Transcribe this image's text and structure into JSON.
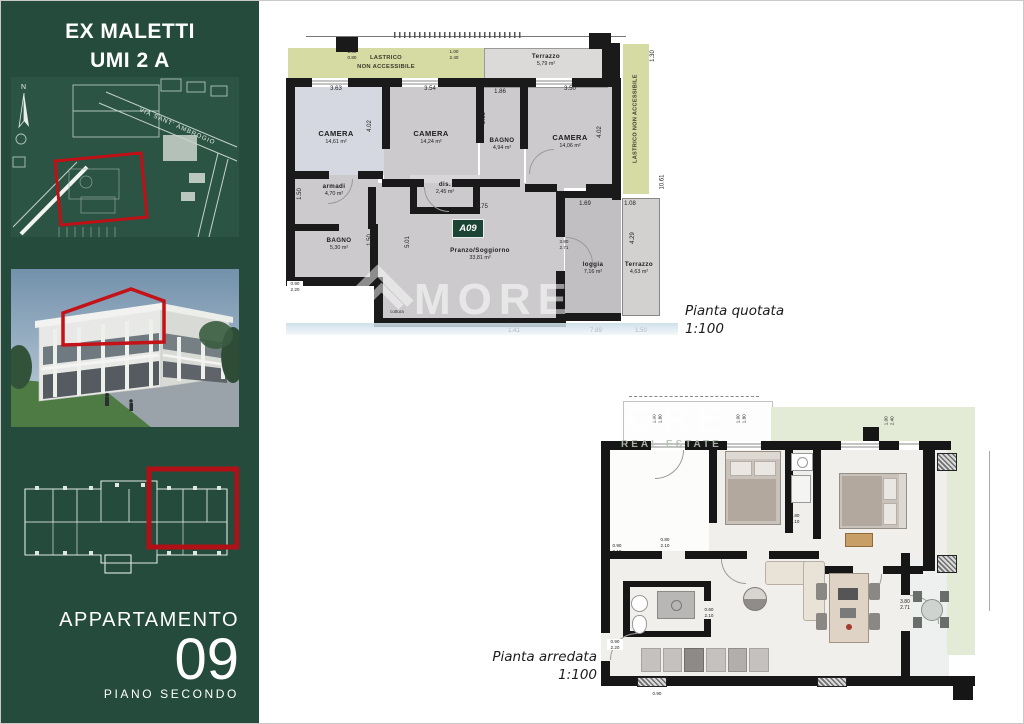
{
  "sidebar": {
    "title_line1": "EX MALETTI",
    "title_line2": "UMI 2 A",
    "north_label": "N",
    "street_label": "VIA SANT' AMBROGIO",
    "apartment_label": "APPARTAMENTO",
    "apartment_number": "09",
    "floor_label": "PIANO SECONDO"
  },
  "colors": {
    "sidebar_green": "#254b3c",
    "highlight_red": "#b5151b",
    "lastrico_olive": "#d6dba4",
    "lastrico_pale_green": "#e3ead6",
    "badge_green": "#1c4435"
  },
  "watermark": {
    "fragment_large": "MORE",
    "fragment_small": "REAL ESTATE"
  },
  "plans": {
    "quotata": {
      "caption": "Pianta quotata",
      "scale": "1:100",
      "badge": "A09",
      "lastrico_top": "LASTRICO\nNON ACCESSIBILE",
      "lastrico_right": "LASTRICO NON ACCESSIBILE",
      "rooms": [
        {
          "name": "CAMERA",
          "area": "14,61 m²"
        },
        {
          "name": "CAMERA",
          "area": "14,24 m²"
        },
        {
          "name": "BAGNO",
          "area": "4,94 m²"
        },
        {
          "name": "CAMERA",
          "area": "14,06 m²"
        },
        {
          "name": "armadi",
          "area": "4,70 m²"
        },
        {
          "name": "BAGNO",
          "area": "5,30 m²"
        },
        {
          "name": "dis.",
          "area": "2,45 m²"
        },
        {
          "name": "Pranzo/Soggiorno",
          "area": "33,81 m²"
        },
        {
          "name": "loggia",
          "area": "7,16 m²"
        },
        {
          "name": "Terrazzo",
          "area": "4,63 m²"
        },
        {
          "name": "Terrazzo",
          "area": "5,79 m²"
        }
      ],
      "dims": {
        "cam1_w": "3.63",
        "cam2_w": "3.54",
        "bagno1_w": "1.86",
        "cam3_w": "3.50",
        "cam1_h": "4.02",
        "cam3_h": "4.02",
        "bagno1_h": "2.65",
        "armadi_h": "1.50",
        "bagno2_h": "1.50",
        "living_h": "5.01",
        "living_w": "6.75",
        "loggia_w": "1.69",
        "terr2_w": "1.08",
        "terr2_h": "4.29",
        "right_total": "10.61",
        "right_top": "1.30",
        "door_pair": "3.80\n2.71",
        "bottom_1": "1.41",
        "bottom_2": "7.89",
        "bottom_3": "1.50",
        "left_pair": "0.90\n2.20",
        "win_pair_1": "1.00\n0.80",
        "win_pair_2": "1.00\n2.40",
        "cottura": "cottura"
      }
    },
    "arredata": {
      "caption": "Pianta arredata",
      "scale": "1:100",
      "pairs": [
        "1.00\n1.80",
        "1.00\n1.80",
        "1.00\n2.40",
        "0.80\n2.10",
        "0.90\n2.10",
        "0.80\n2.10",
        "0.60\n2.10",
        "0.90\n2.20",
        "3.80\n2.71",
        "0.90"
      ]
    }
  }
}
